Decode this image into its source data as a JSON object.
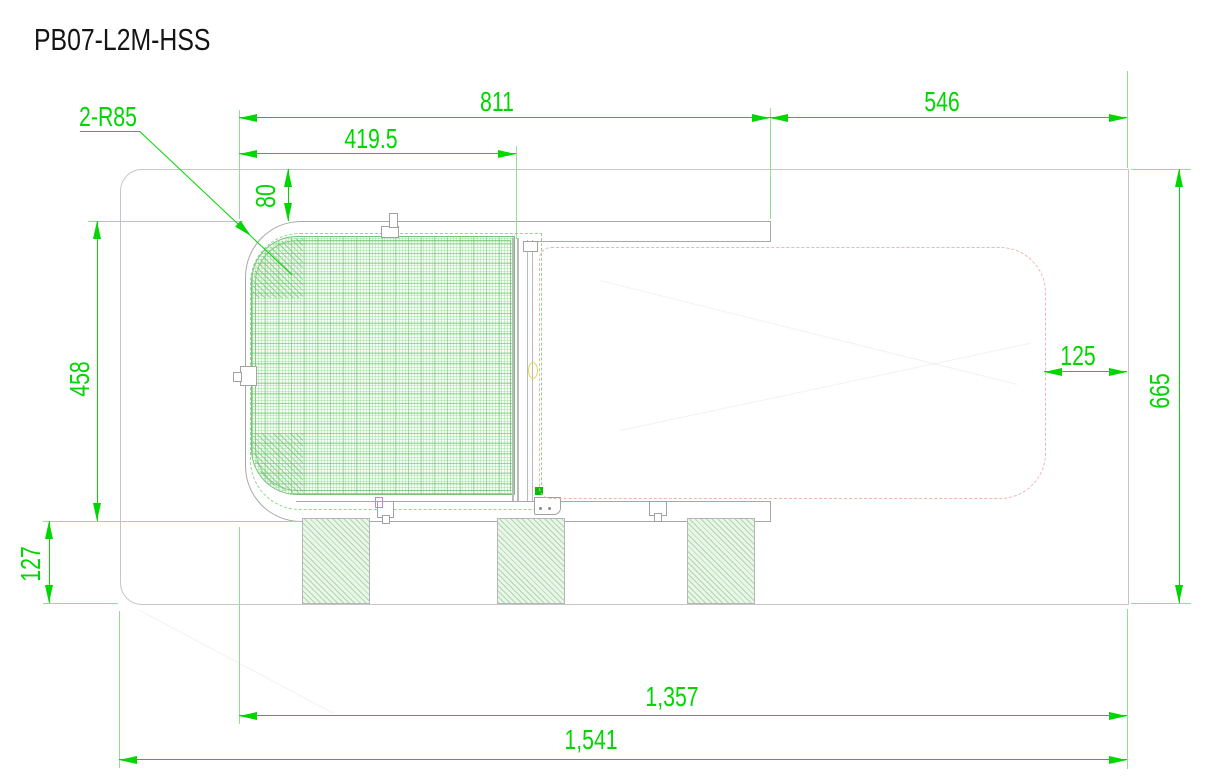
{
  "title": "PB07-L2M-HSS",
  "colors": {
    "dimension_green": "#00d600",
    "extension_green": "#8fe08f",
    "outline_gray": "#c5c5c5",
    "part_gray": "#a8a8a8",
    "phantom_pink": "#f0b4b4",
    "hatch_green": "#7cc07c"
  },
  "dimensions": {
    "corner_radius": "2-R85",
    "top_span_left": "811",
    "top_span_right": "546",
    "cover_width": "419.5",
    "top_offset": "80",
    "cover_height": "458",
    "foot_height": "127",
    "right_offset": "125",
    "total_height": "665",
    "inner_length": "1,357",
    "total_length": "1,541"
  }
}
